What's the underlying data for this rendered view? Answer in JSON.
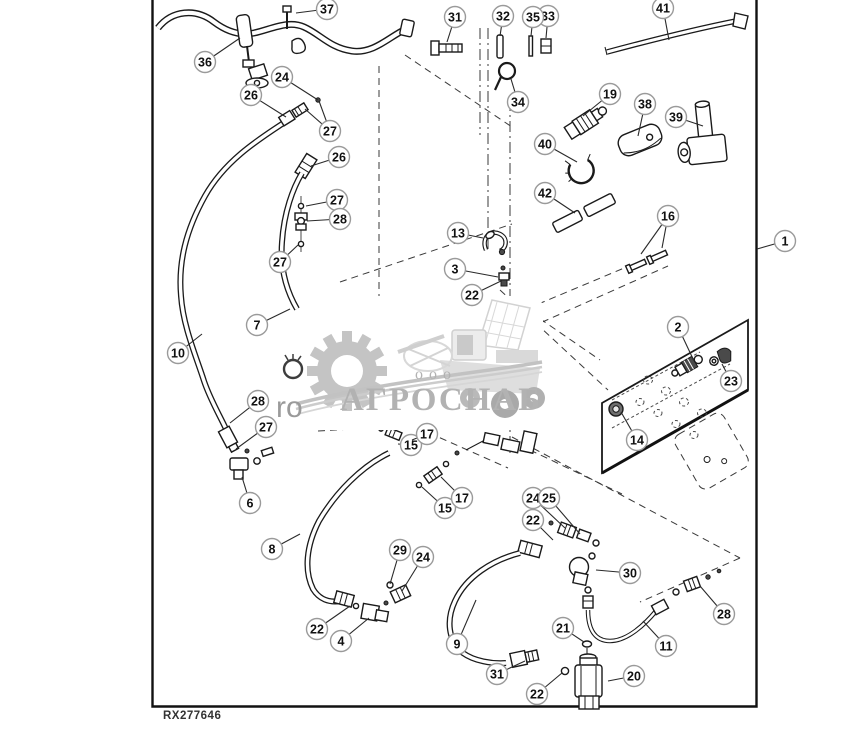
{
  "figure": {
    "code": "RX277646"
  },
  "watermark": {
    "prefix": "ооо",
    "company": "АГРОСНАБ",
    "fragment": "ro"
  },
  "colors": {
    "line": "#1a1a1a",
    "watermark_gray": "#b2b2b2",
    "callout_ring": "#9a9a9a"
  },
  "callouts": [
    {
      "label": "1",
      "x": 785,
      "y": 241,
      "leaders": [
        [
          757,
          249
        ]
      ]
    },
    {
      "label": "2",
      "x": 678,
      "y": 327,
      "leaders": [
        [
          694,
          361
        ]
      ]
    },
    {
      "label": "3",
      "x": 455,
      "y": 269,
      "leaders": [
        [
          498,
          277
        ]
      ]
    },
    {
      "label": "4",
      "x": 341,
      "y": 641,
      "leaders": [
        [
          369,
          618
        ]
      ]
    },
    {
      "label": "6",
      "x": 250,
      "y": 503,
      "leaders": [
        [
          242,
          477
        ]
      ]
    },
    {
      "label": "7",
      "x": 257,
      "y": 325,
      "leaders": [
        [
          290,
          309
        ]
      ]
    },
    {
      "label": "8",
      "x": 272,
      "y": 549,
      "leaders": [
        [
          300,
          534
        ]
      ]
    },
    {
      "label": "9",
      "x": 457,
      "y": 644,
      "leaders": [
        [
          476,
          600
        ]
      ]
    },
    {
      "label": "10",
      "x": 178,
      "y": 353,
      "leaders": [
        [
          202,
          334
        ]
      ]
    },
    {
      "label": "11",
      "x": 666,
      "y": 646,
      "leaders": [
        [
          643,
          621
        ]
      ]
    },
    {
      "label": "13",
      "x": 458,
      "y": 233,
      "leaders": [
        [
          483,
          238
        ]
      ]
    },
    {
      "label": "14",
      "x": 637,
      "y": 440,
      "leaders": [
        [
          621,
          412
        ]
      ]
    },
    {
      "label": "15",
      "x": 411,
      "y": 445,
      "leaders": [
        [
          398,
          444
        ]
      ]
    },
    {
      "label": "15",
      "x": 445,
      "y": 508,
      "leaders": [
        [
          422,
          487
        ]
      ]
    },
    {
      "label": "16",
      "x": 668,
      "y": 216,
      "leaders": [
        [
          641,
          254
        ],
        [
          662,
          248
        ]
      ]
    },
    {
      "label": "17",
      "x": 427,
      "y": 434,
      "leaders": [
        [
          412,
          440
        ]
      ]
    },
    {
      "label": "17",
      "x": 462,
      "y": 498,
      "leaders": [
        [
          441,
          477
        ]
      ]
    },
    {
      "label": "19",
      "x": 610,
      "y": 94,
      "leaders": [
        [
          583,
          116
        ]
      ]
    },
    {
      "label": "20",
      "x": 634,
      "y": 676,
      "leaders": [
        [
          608,
          681
        ]
      ]
    },
    {
      "label": "21",
      "x": 563,
      "y": 628,
      "leaders": [
        [
          584,
          642
        ]
      ]
    },
    {
      "label": "22",
      "x": 472,
      "y": 295,
      "leaders": [
        [
          501,
          281
        ]
      ]
    },
    {
      "label": "22",
      "x": 537,
      "y": 694,
      "leaders": [
        [
          562,
          673
        ]
      ]
    },
    {
      "label": "22",
      "x": 533,
      "y": 520,
      "leaders": [
        [
          553,
          540
        ]
      ]
    },
    {
      "label": "22",
      "x": 317,
      "y": 629,
      "leaders": [
        [
          350,
          606
        ]
      ]
    },
    {
      "label": "23",
      "x": 731,
      "y": 381,
      "leaders": [
        [
          722,
          364
        ]
      ]
    },
    {
      "label": "24",
      "x": 282,
      "y": 77,
      "leaders": [
        [
          318,
          100
        ]
      ]
    },
    {
      "label": "24",
      "x": 423,
      "y": 557,
      "leaders": [
        [
          402,
          591
        ]
      ]
    },
    {
      "label": "24",
      "x": 533,
      "y": 498,
      "leaders": [
        [
          565,
          528
        ]
      ]
    },
    {
      "label": "25",
      "x": 549,
      "y": 498,
      "leaders": [
        [
          580,
          534
        ]
      ]
    },
    {
      "label": "26",
      "x": 251,
      "y": 95,
      "leaders": [
        [
          286,
          117
        ]
      ]
    },
    {
      "label": "26",
      "x": 339,
      "y": 157,
      "leaders": [
        [
          311,
          166
        ]
      ]
    },
    {
      "label": "27",
      "x": 330,
      "y": 131,
      "leaders": [
        [
          305,
          109
        ],
        [
          319,
          101
        ]
      ]
    },
    {
      "label": "27",
      "x": 337,
      "y": 200,
      "leaders": [
        [
          306,
          206
        ]
      ]
    },
    {
      "label": "27",
      "x": 280,
      "y": 262,
      "leaders": [
        [
          298,
          245
        ]
      ]
    },
    {
      "label": "27",
      "x": 266,
      "y": 427,
      "leaders": [
        [
          236,
          449
        ]
      ]
    },
    {
      "label": "28",
      "x": 340,
      "y": 219,
      "leaders": [
        [
          307,
          221
        ]
      ]
    },
    {
      "label": "28",
      "x": 258,
      "y": 401,
      "leaders": [
        [
          230,
          423
        ]
      ]
    },
    {
      "label": "28",
      "x": 724,
      "y": 614,
      "leaders": [
        [
          700,
          586
        ]
      ]
    },
    {
      "label": "29",
      "x": 400,
      "y": 550,
      "leaders": [
        [
          390,
          584
        ]
      ]
    },
    {
      "label": "30",
      "x": 630,
      "y": 573,
      "leaders": [
        [
          596,
          570
        ]
      ]
    },
    {
      "label": "31",
      "x": 455,
      "y": 17,
      "leaders": [
        [
          447,
          42
        ]
      ]
    },
    {
      "label": "31",
      "x": 497,
      "y": 674,
      "leaders": [
        [
          525,
          661
        ]
      ]
    },
    {
      "label": "32",
      "x": 503,
      "y": 16,
      "leaders": [
        [
          500,
          36
        ]
      ]
    },
    {
      "label": "33",
      "x": 548,
      "y": 16,
      "leaders": [
        [
          546,
          38
        ]
      ]
    },
    {
      "label": "34",
      "x": 518,
      "y": 102,
      "leaders": [
        [
          511,
          79
        ]
      ]
    },
    {
      "label": "35",
      "x": 533,
      "y": 17,
      "leaders": [
        [
          531,
          36
        ]
      ]
    },
    {
      "label": "36",
      "x": 205,
      "y": 62,
      "leaders": [
        [
          240,
          38
        ]
      ]
    },
    {
      "label": "37",
      "x": 327,
      "y": 9,
      "leaders": [
        [
          296,
          13
        ]
      ]
    },
    {
      "label": "38",
      "x": 645,
      "y": 104,
      "leaders": [
        [
          638,
          136
        ]
      ]
    },
    {
      "label": "39",
      "x": 676,
      "y": 117,
      "leaders": [
        [
          703,
          126
        ]
      ]
    },
    {
      "label": "40",
      "x": 545,
      "y": 144,
      "leaders": [
        [
          577,
          162
        ]
      ]
    },
    {
      "label": "41",
      "x": 663,
      "y": 8,
      "leaders": [
        [
          669,
          40
        ]
      ]
    },
    {
      "label": "42",
      "x": 545,
      "y": 193,
      "leaders": [
        [
          575,
          213
        ]
      ]
    }
  ]
}
